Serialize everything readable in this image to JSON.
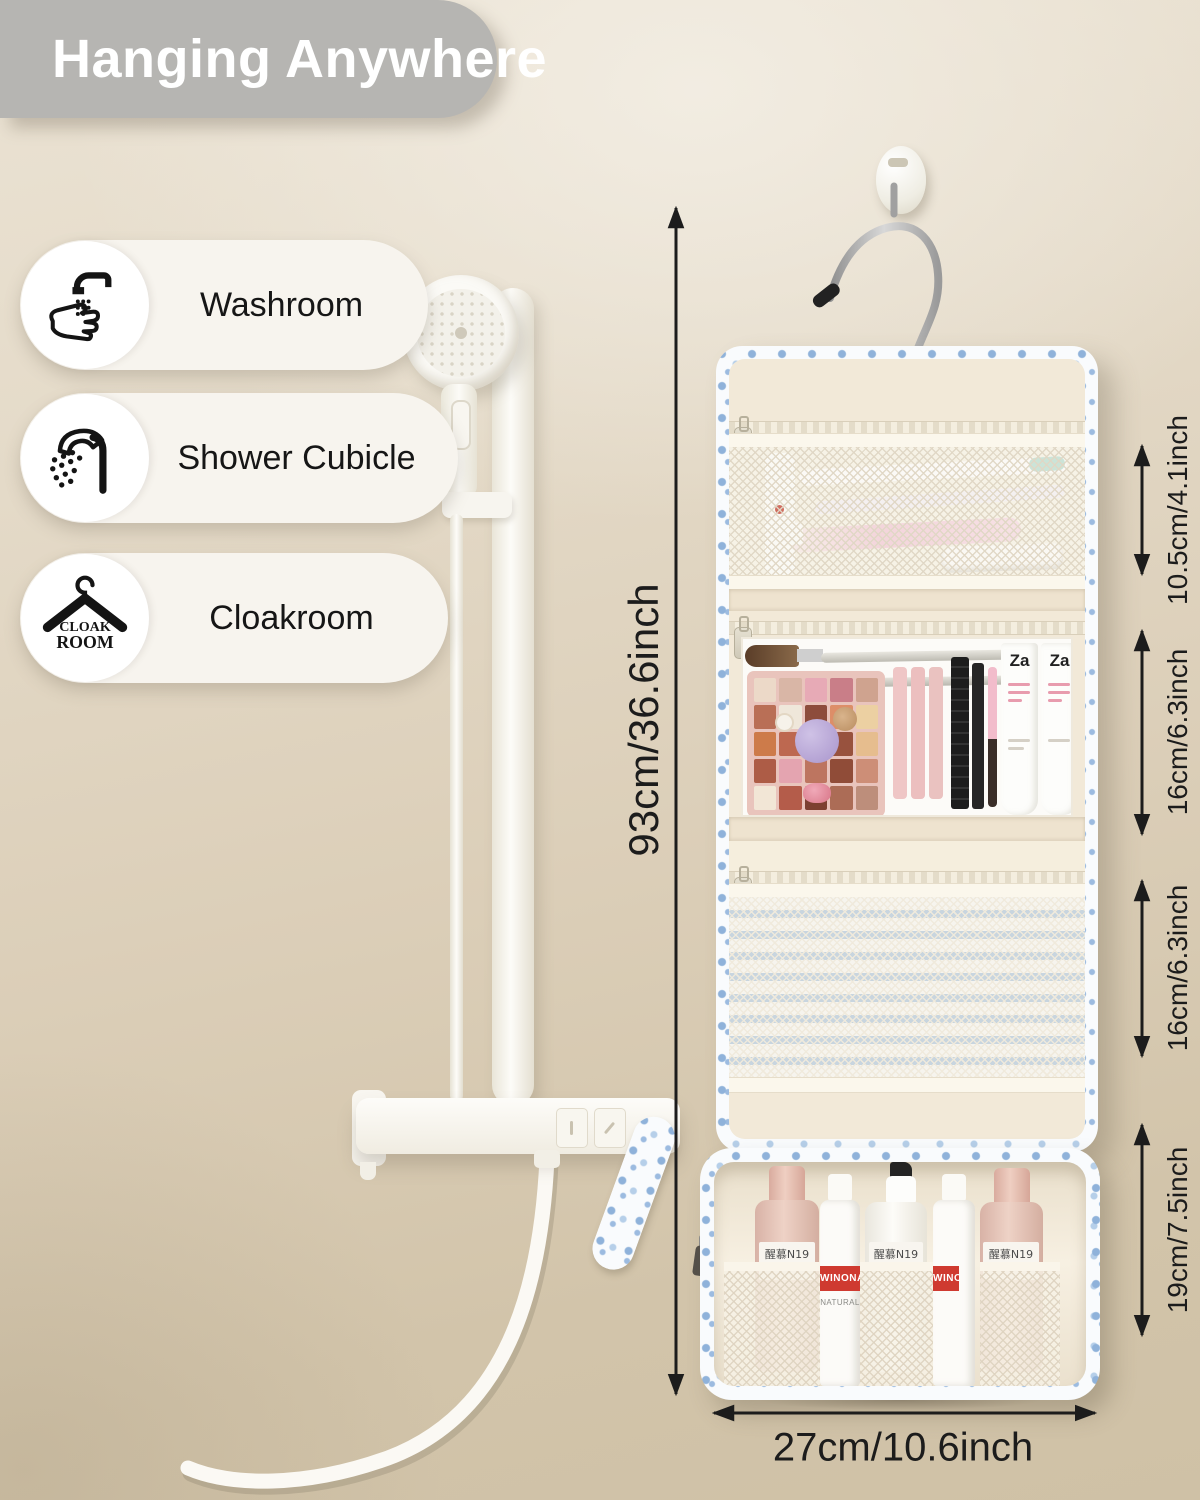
{
  "banner": {
    "title": "Hanging Anywhere"
  },
  "locations": [
    {
      "label": "Washroom",
      "icon": "handwash-icon"
    },
    {
      "label": "Shower Cubicle",
      "icon": "shower-icon"
    },
    {
      "label": "Cloakroom",
      "icon": "hanger-icon",
      "icon_text": {
        "line1": "CLOAK",
        "line2": "ROOM"
      }
    }
  ],
  "dimensions": {
    "total_height": "93cm/36.6inch",
    "section_top": "10.5cm/4.1inch",
    "section_middle": "16cm/6.3inch",
    "section_lower": "16cm/6.3inch",
    "section_bottom": "19cm/7.5inch",
    "width": "27cm/10.6inch"
  },
  "products": {
    "bottle_brand": "醒慕N19",
    "pump_brand": "WINONA",
    "pump_sub": "NATURAL",
    "tube_brand": "Za",
    "palette_shades": [
      "#ecd9c8",
      "#d9b6a6",
      "#e7aab6",
      "#c97e88",
      "#cfa38f",
      "#b96f56",
      "#efe7da",
      "#8d4c3c",
      "#dd8e68",
      "#ecd0a2",
      "#cd7b4a",
      "#bd6850",
      "#7f4839",
      "#98523e",
      "#e6bd8e",
      "#ad5c46",
      "#e4a4b0",
      "#bd7560",
      "#904c38",
      "#cd8e77",
      "#f2e6d6",
      "#b45c4a",
      "#7d4031",
      "#ac6c56",
      "#bd8e7b"
    ]
  },
  "colors": {
    "wall_beige": "#dcd0bb",
    "banner_gray": "#b6b5b2",
    "pill_cream": "#f7f4ee",
    "bag_cream": "#f2e9d8",
    "floral_blue": "#9fc0e2",
    "stripe_blue": "#bccedd",
    "label_red": "#cf3a30",
    "dimension_ink": "#1c1c1c"
  }
}
